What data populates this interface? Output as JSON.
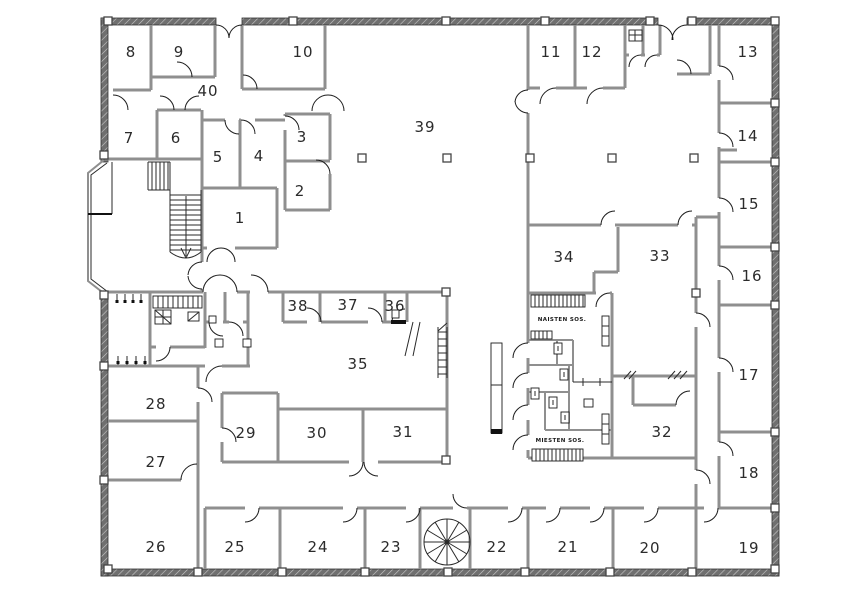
{
  "plan": {
    "type": "building-floor-plan",
    "colors": {
      "interior_wall": "#8f8f8f",
      "outer_wall": "#6f6f6f",
      "line": "#1c1c1c",
      "text": "#2b2b2b",
      "background": "#ffffff"
    },
    "areas": {
      "naisten_label": "NAISTEN SOS.",
      "miesten_label": "MIESTEN SOS."
    }
  },
  "rooms": [
    {
      "label": "1"
    },
    {
      "label": "2"
    },
    {
      "label": "3"
    },
    {
      "label": "4"
    },
    {
      "label": "5"
    },
    {
      "label": "6"
    },
    {
      "label": "7"
    },
    {
      "label": "8"
    },
    {
      "label": "9"
    },
    {
      "label": "10"
    },
    {
      "label": "11"
    },
    {
      "label": "12"
    },
    {
      "label": "13"
    },
    {
      "label": "14"
    },
    {
      "label": "15"
    },
    {
      "label": "16"
    },
    {
      "label": "17"
    },
    {
      "label": "18"
    },
    {
      "label": "19"
    },
    {
      "label": "20"
    },
    {
      "label": "21"
    },
    {
      "label": "22"
    },
    {
      "label": "23"
    },
    {
      "label": "24"
    },
    {
      "label": "25"
    },
    {
      "label": "26"
    },
    {
      "label": "27"
    },
    {
      "label": "28"
    },
    {
      "label": "29"
    },
    {
      "label": "30"
    },
    {
      "label": "31"
    },
    {
      "label": "32"
    },
    {
      "label": "33"
    },
    {
      "label": "34"
    },
    {
      "label": "35"
    },
    {
      "label": "36"
    },
    {
      "label": "37"
    },
    {
      "label": "38"
    },
    {
      "label": "39"
    },
    {
      "label": "40"
    }
  ]
}
